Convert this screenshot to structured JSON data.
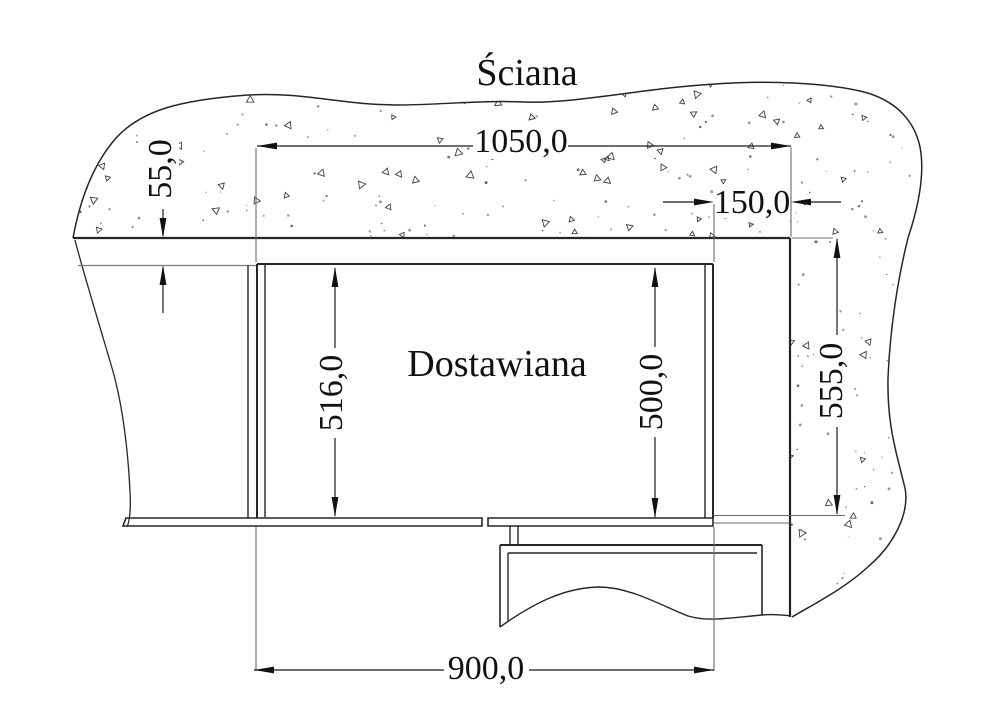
{
  "drawing": {
    "title": "Ściana",
    "area_label": "Dostawiana",
    "dimensions": {
      "top_width": {
        "label": "1050,0",
        "value": 1050.0,
        "unit": "mm",
        "orientation": "horizontal"
      },
      "cornice_height": {
        "label": "55,0",
        "value": 55.0,
        "unit": "mm",
        "orientation": "vertical"
      },
      "niche_width": {
        "label": "150,0",
        "value": 150.0,
        "unit": "mm",
        "orientation": "horizontal"
      },
      "left_height": {
        "label": "516,0",
        "value": 516.0,
        "unit": "mm",
        "orientation": "vertical"
      },
      "right_height": {
        "label": "500,0",
        "value": 500.0,
        "unit": "mm",
        "orientation": "vertical"
      },
      "wall_height": {
        "label": "555,0",
        "value": 555.0,
        "unit": "mm",
        "orientation": "vertical"
      },
      "bottom_width": {
        "label": "900,0",
        "value": 900.0,
        "unit": "mm",
        "orientation": "horizontal"
      }
    },
    "colors": {
      "object_line": "#262626",
      "dimension_line": "#1a1a1a",
      "extension_line": "#6b6b6b",
      "stipple": "#3f3f3f",
      "background": "#ffffff"
    }
  }
}
